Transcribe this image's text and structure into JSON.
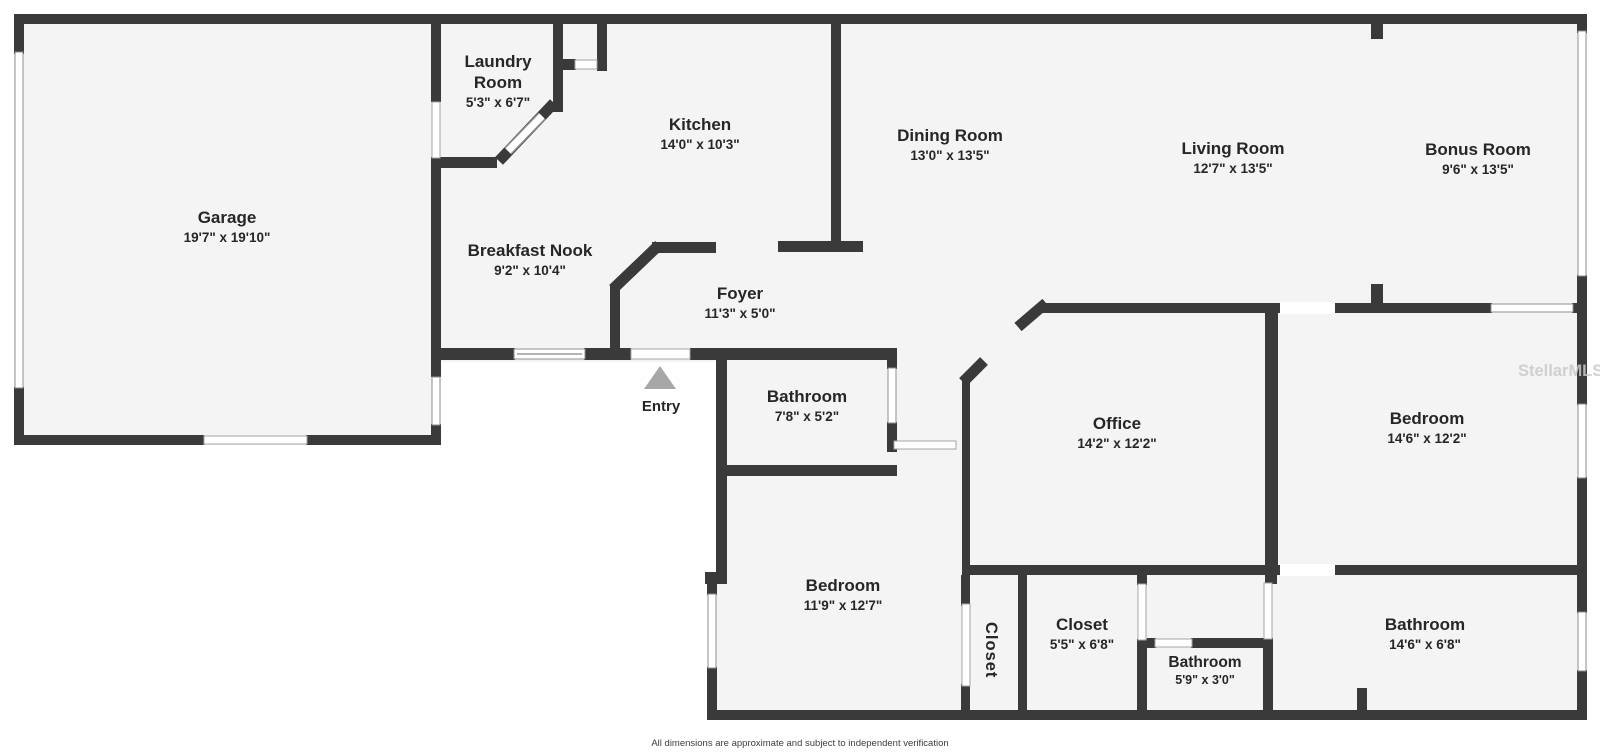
{
  "plan": {
    "watermark": "StellarMLS",
    "footer": "All dimensions are approximate and subject to independent verification",
    "entry_label": "Entry"
  },
  "colors": {
    "wall": "#3a3a3a",
    "floor": "#f4f4f4",
    "background": "#ffffff",
    "entry_arrow": "#a7a7a7",
    "label_text": "#262626",
    "watermark_text": "#c9c9c9"
  },
  "rooms": [
    {
      "name": "Garage",
      "dims": "19'7\" x 19'10\""
    },
    {
      "name": "Laundry Room",
      "dims": "5'3\" x 6'7\""
    },
    {
      "name": "Kitchen",
      "dims": "14'0\" x 10'3\""
    },
    {
      "name": "Dining Room",
      "dims": "13'0\" x 13'5\""
    },
    {
      "name": "Living Room",
      "dims": "12'7\" x 13'5\""
    },
    {
      "name": "Bonus Room",
      "dims": "9'6\" x 13'5\""
    },
    {
      "name": "Breakfast Nook",
      "dims": "9'2\" x 10'4\""
    },
    {
      "name": "Foyer",
      "dims": "11'3\" x 5'0\""
    },
    {
      "name": "Bathroom",
      "dims": "7'8\" x 5'2\""
    },
    {
      "name": "Office",
      "dims": "14'2\" x 12'2\""
    },
    {
      "name": "Bedroom",
      "dims": "14'6\" x 12'2\""
    },
    {
      "name": "Bedroom",
      "dims": "11'9\" x 12'7\""
    },
    {
      "name": "Closet",
      "dims": ""
    },
    {
      "name": "Closet",
      "dims": "5'5\" x 6'8\""
    },
    {
      "name": "Bathroom",
      "dims": "5'9\" x 3'0\""
    },
    {
      "name": "Bathroom",
      "dims": "14'6\" x 6'8\""
    }
  ]
}
